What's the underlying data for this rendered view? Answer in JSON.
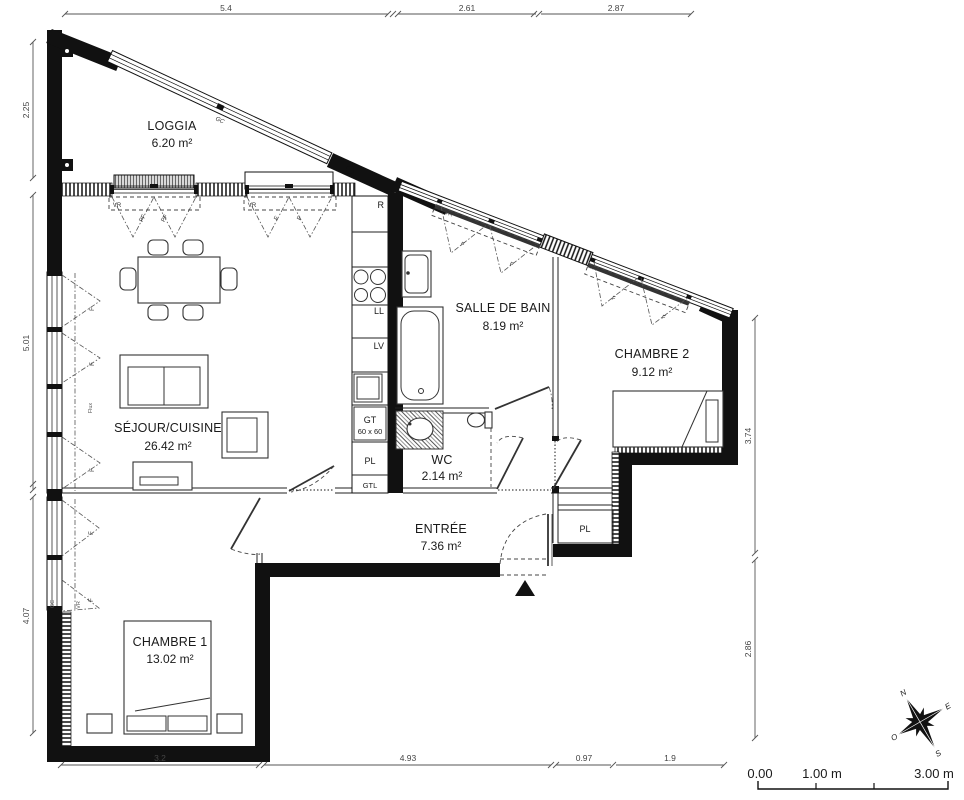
{
  "plan": {
    "rooms": [
      {
        "name": "LOGGIA",
        "area": "6.20 m²"
      },
      {
        "name": "SÉJOUR/CUISINE",
        "area": "26.42 m²"
      },
      {
        "name": "SALLE DE BAIN",
        "area": "8.19 m²"
      },
      {
        "name": "CHAMBRE 2",
        "area": "9.12 m²"
      },
      {
        "name": "WC",
        "area": "2.14 m²"
      },
      {
        "name": "ENTRÉE",
        "area": "7.36 m²"
      },
      {
        "name": "CHAMBRE 1",
        "area": "13.02 m²"
      }
    ],
    "kitchen": {
      "fridge": "R",
      "washer": "LL",
      "dishwasher": "LV",
      "duct": "GT",
      "duct_size": "60 x 60",
      "closet": "PL",
      "gtl": "GTL"
    },
    "labels": {
      "roller_shutter": "VR",
      "french_door": "PF",
      "casement": "F",
      "railing": "GC",
      "flux": "Flux"
    },
    "dimensions": {
      "top": [
        "5.4",
        "2.61",
        "2.87"
      ],
      "left": [
        "2.25",
        "5.01",
        "4.07"
      ],
      "right": [
        "3.74",
        "2.86"
      ],
      "bottom": [
        "3.2",
        "4.93",
        "0.97",
        "1.9"
      ]
    },
    "scale_bar": {
      "start": "0.00",
      "mid": "1.00 m",
      "end": "3.00 m"
    },
    "compass": {
      "north": "N",
      "east": "E",
      "south": "S",
      "west": "O"
    }
  }
}
